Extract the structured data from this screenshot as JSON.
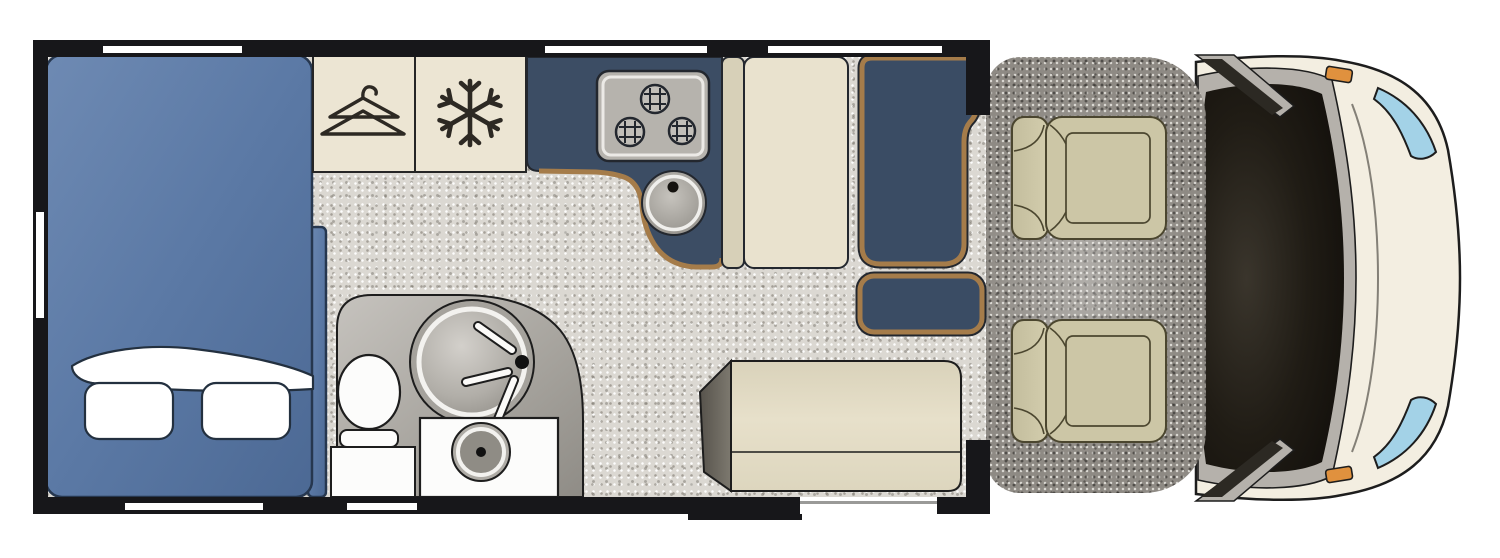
{
  "scene": {
    "kind": "motorhome-floorplan",
    "view": "top-down",
    "cab_facing": "right"
  },
  "colors": {
    "background": "#ffffff",
    "wall": "#17171a",
    "window": "#ffffff",
    "floor_base": "#dbd8d2",
    "carpet_base": "#8e8a84",
    "bed_blue": "#5d7ba6",
    "bed_blue_dark": "#4a6792",
    "bed_outline": "#26374f",
    "linen_white": "#ffffff",
    "cabinet_cream": "#ece5d3",
    "icon_ink": "#2d2923",
    "counter_navy": "#3c4d64",
    "counter_trim": "#a57c4a",
    "hob_gray": "#b6b3ad",
    "fixture_gray": "#aaa7a1",
    "fixture_white": "#fcfcfb",
    "seat_cream": "#e9e2ce",
    "seat_cream_dark": "#d7d0b8",
    "table_navy": "#3a4c64",
    "table_trim": "#a57c4a",
    "table_rim": "#23272e",
    "sofa_cream": "#e3dcc6",
    "sofa_wedge": "#6e6a62",
    "cab_seat": "#ccc6a6",
    "cab_seat_line": "#4b462f",
    "hood_ivory": "#f3eee1",
    "windshield_black": "#16130e",
    "cowl_gray": "#b5b1ab",
    "headlight_blue": "#a3d2e7",
    "mirror_orange": "#e0913e",
    "outline": "#1d1d1d",
    "threshold_gray": "#9a9a98"
  },
  "rooms": [
    {
      "id": "rear-bedroom",
      "furniture": [
        "double-bed",
        "two-pillows",
        "folded-sheet",
        "wardrobe",
        "refrigerator"
      ]
    },
    {
      "id": "washroom",
      "furniture": [
        "toilet",
        "circular-shower",
        "washbasin"
      ]
    },
    {
      "id": "kitchen",
      "furniture": [
        "l-shaped-counter",
        "three-burner-hob",
        "round-sink"
      ]
    },
    {
      "id": "lounge",
      "furniture": [
        "dinette-bench",
        "dinette-table",
        "side-seat",
        "sofa"
      ]
    },
    {
      "id": "cab",
      "furniture": [
        "driver-swivel-seat",
        "passenger-swivel-seat",
        "dashboard",
        "windshield",
        "wing-mirrors",
        "headlights"
      ]
    }
  ],
  "icons": [
    {
      "name": "hanger-icon",
      "meaning": "wardrobe"
    },
    {
      "name": "snowflake-icon",
      "meaning": "refrigerator-freezer"
    }
  ],
  "openings": {
    "windows_top_wall": 3,
    "windows_bottom_wall": 2,
    "windows_rear_wall": 1,
    "entry_door_bottom": 1,
    "entry_step": 1
  },
  "hob_burner_count": 3
}
